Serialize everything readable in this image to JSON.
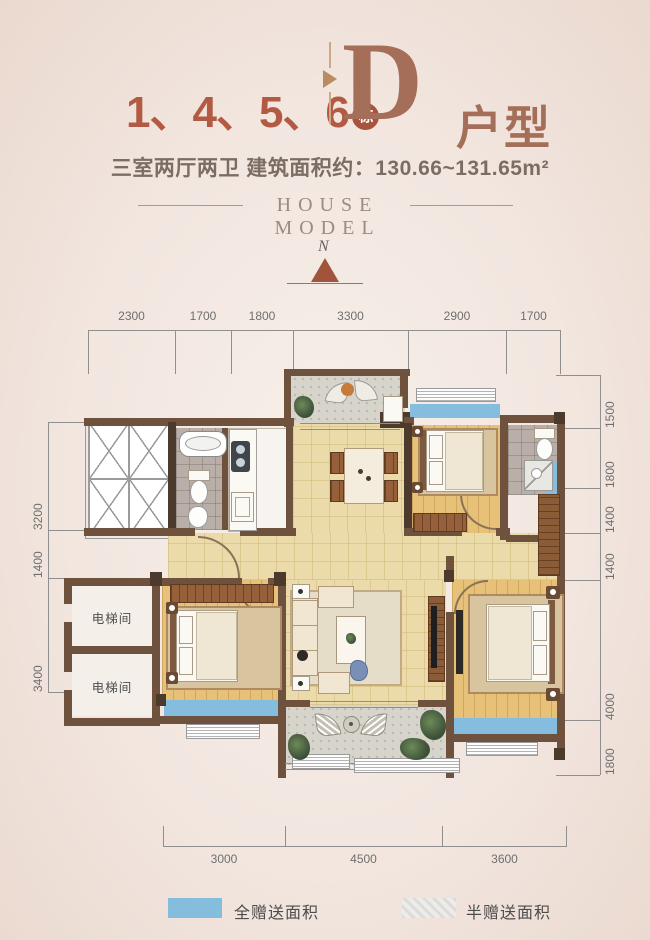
{
  "header": {
    "buildings": "1、4、5、6",
    "building_unit": "栋",
    "type_letter": "D",
    "type_suffix": "户型",
    "subtitle": "三室两厅两卫  建筑面积约：130.66~131.65m²",
    "house_model": "HOUSE MODEL",
    "north_label": "N"
  },
  "dims": {
    "top": [
      "2300",
      "1700",
      "1800",
      "3300",
      "2900",
      "1700"
    ],
    "left": [
      "3200",
      "1400",
      "3400"
    ],
    "right": [
      "1500",
      "1800",
      "1400",
      "1400",
      "4000",
      "1800"
    ],
    "bottom": [
      "3000",
      "4500",
      "3600"
    ]
  },
  "rooms": {
    "elevator_1": "电梯间",
    "elevator_2": "电梯间"
  },
  "legend": {
    "full_gift": "全赠送面积",
    "half_gift": "半赠送面积"
  },
  "colors": {
    "accent_red": "#b25a43",
    "title_brown": "#a56e58",
    "wall_brown": "#6f523d",
    "window_blue": "#84bddd",
    "wood_light": "#ecdbaa",
    "wood_dark": "#e6c177",
    "tile_gray": "#b9afa8",
    "stone_gray": "#d7d4cb"
  }
}
